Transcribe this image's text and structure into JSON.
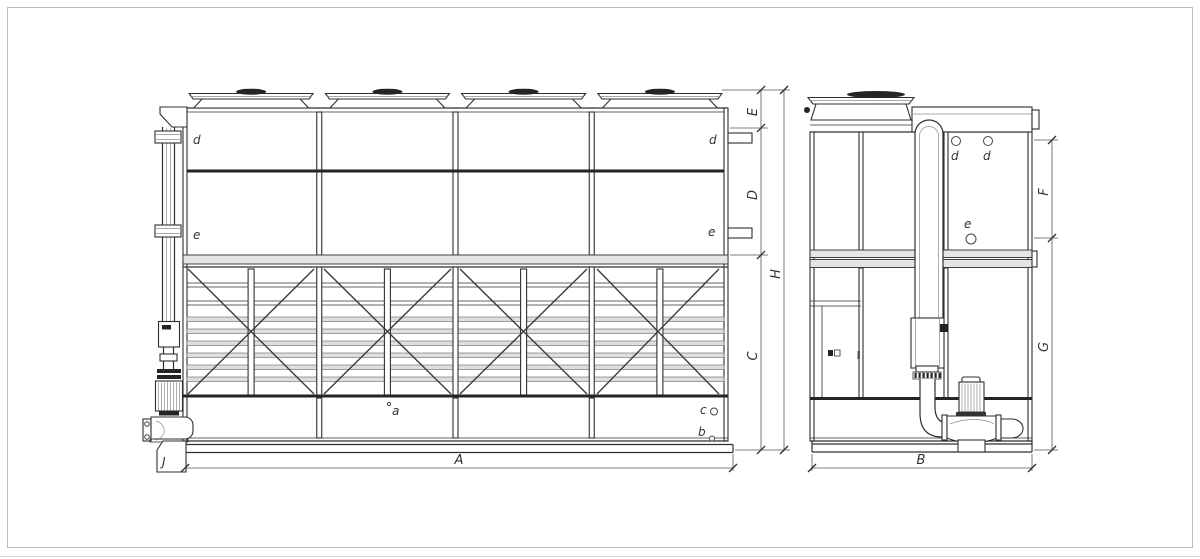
{
  "colors": {
    "line": "#2f2f2f",
    "muted": "#8c8c8c",
    "dim_line": "#555555",
    "dark": "#242424",
    "band_fill": "#e4e4e4",
    "slat_fill": "#dedede",
    "frame": "#bdbdbd",
    "background": "#ffffff"
  },
  "labels": {
    "dim_A": "A",
    "dim_B": "B",
    "dim_C": "C",
    "dim_D": "D",
    "dim_E": "E",
    "dim_F": "F",
    "dim_G": "G",
    "dim_H": "H",
    "dim_J": "J",
    "part_a": "a",
    "part_b": "b",
    "part_c": "c",
    "part_d": "d",
    "part_e": "e"
  }
}
